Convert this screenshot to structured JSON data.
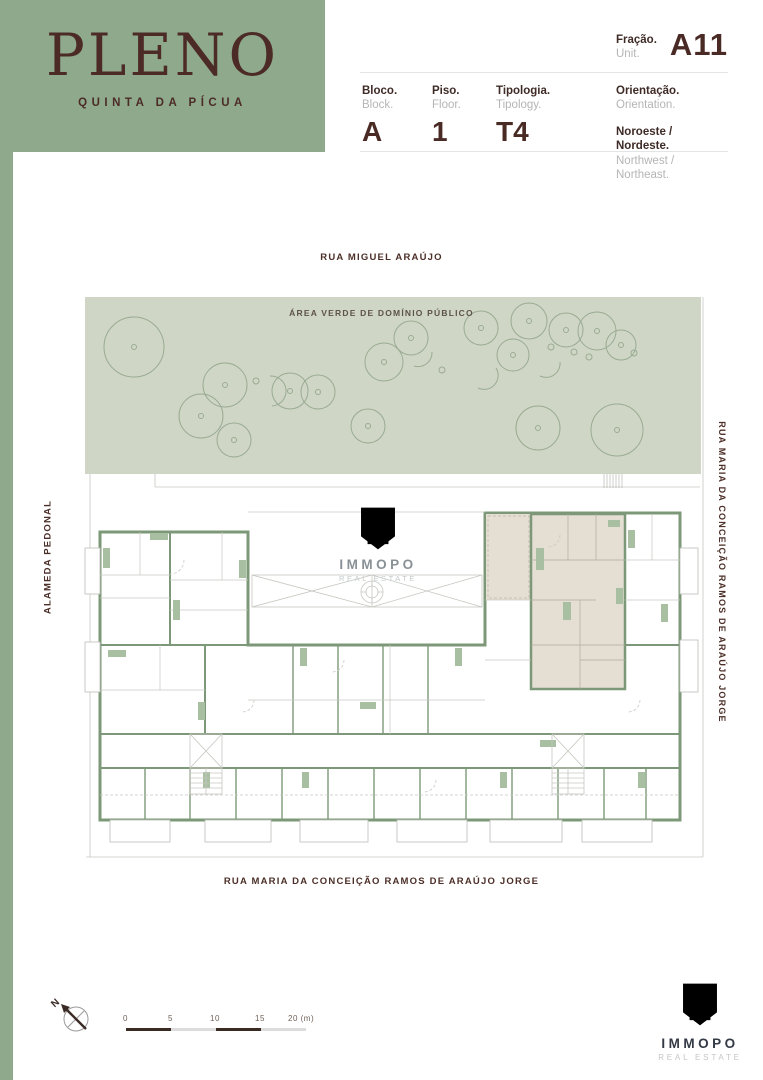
{
  "colors": {
    "brand_green": "#8fa98c",
    "wall_green": "#7d9878",
    "furniture_green": "#a9bfa1",
    "green_area_bg": "#cfd6c5",
    "tree_stroke": "#9aab92",
    "dark_brown": "#4a2a25",
    "label_gray": "#b5b5b5",
    "beige_highlight": "#e4ded3",
    "gold": "#c7a36f",
    "footer_navy": "#333a45"
  },
  "brand": {
    "name": "PLENO",
    "subtitle": "QUINTA DA PÍCUA"
  },
  "header": {
    "fraction": {
      "label_pt": "Fração.",
      "label_en": "Unit.",
      "value": "A11"
    },
    "block": {
      "label_pt": "Bloco.",
      "label_en": "Block.",
      "value": "A"
    },
    "floor": {
      "label_pt": "Piso.",
      "label_en": "Floor.",
      "value": "1"
    },
    "typology": {
      "label_pt": "Tipologia.",
      "label_en": "Tipology.",
      "value": "T4"
    },
    "orientation": {
      "label_pt": "Orientação.",
      "label_en": "Orientation.",
      "value_pt": "Noroeste / Nordeste.",
      "value_en": "Northwest / Northeast."
    }
  },
  "plan": {
    "street_top": "RUA MIGUEL ARAÚJO",
    "green_area_label": "ÁREA VERDE DE DOMÍNIO PÚBLICO",
    "street_left": "ALAMEDA PEDONAL",
    "street_right": "RUA MARIA DA CONCEIÇÃO RAMOS DE ARAÚJO JORGE",
    "street_bottom": "RUA MARIA DA CONCEIÇÃO RAMOS DE ARAÚJO JORGE",
    "highlighted_unit": "A11",
    "watermark": {
      "name": "IMMOPO",
      "tagline": "REAL ESTATE"
    },
    "trees": [
      {
        "x": 134,
        "y": 347,
        "r": 30
      },
      {
        "x": 201,
        "y": 416,
        "r": 22
      },
      {
        "x": 225,
        "y": 385,
        "r": 22
      },
      {
        "x": 234,
        "y": 440,
        "r": 17
      },
      {
        "x": 256,
        "y": 381,
        "r": 3
      },
      {
        "x": 290,
        "y": 391,
        "r": 18
      },
      {
        "x": 318,
        "y": 392,
        "r": 17
      },
      {
        "x": 368,
        "y": 426,
        "r": 17
      },
      {
        "x": 384,
        "y": 362,
        "r": 19
      },
      {
        "x": 411,
        "y": 338,
        "r": 17
      },
      {
        "x": 442,
        "y": 370,
        "r": 3
      },
      {
        "x": 481,
        "y": 328,
        "r": 17
      },
      {
        "x": 513,
        "y": 355,
        "r": 16
      },
      {
        "x": 529,
        "y": 321,
        "r": 18
      },
      {
        "x": 551,
        "y": 347,
        "r": 3
      },
      {
        "x": 538,
        "y": 428,
        "r": 22
      },
      {
        "x": 566,
        "y": 330,
        "r": 17
      },
      {
        "x": 597,
        "y": 331,
        "r": 19
      },
      {
        "x": 621,
        "y": 345,
        "r": 15
      },
      {
        "x": 634,
        "y": 353,
        "r": 3
      },
      {
        "x": 617,
        "y": 430,
        "r": 26
      },
      {
        "x": 589,
        "y": 357,
        "r": 3
      },
      {
        "x": 574,
        "y": 352,
        "r": 3
      }
    ]
  },
  "compass": {
    "label": "N"
  },
  "scalebar": {
    "labels": [
      "0",
      "5",
      "10",
      "15",
      "20 (m)"
    ]
  },
  "footer_logo": {
    "name": "IMMOPO",
    "tagline": "REAL ESTATE"
  }
}
